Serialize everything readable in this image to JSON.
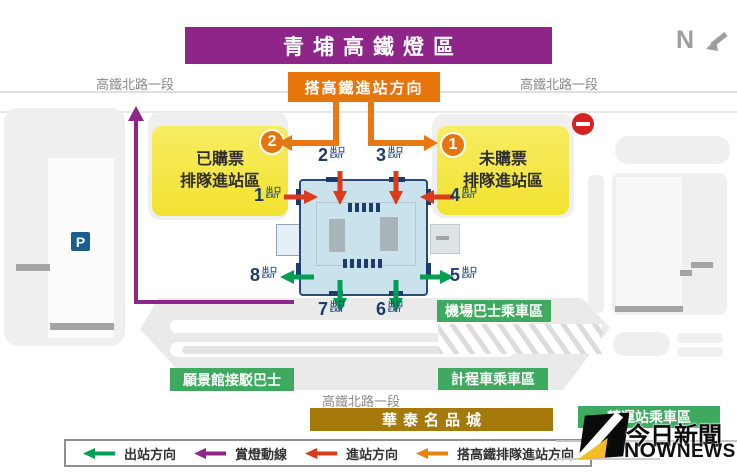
{
  "banner": {
    "title": "青埔高鐵燈區"
  },
  "compass": {
    "label": "N"
  },
  "roads": {
    "top_left": "高鐵北路一段",
    "top_right": "高鐵北路一段",
    "bottom": "高鐵北路一段"
  },
  "callouts": {
    "board_direction": "搭高鐵進站方向"
  },
  "zones": {
    "ticketed": {
      "line1": "已購票",
      "line2": "排隊進站區",
      "badge": "2"
    },
    "unticketed": {
      "line1": "未購票",
      "line2": "排隊進站區",
      "badge": "1"
    },
    "airport_bus": "機場巴士乘車區",
    "taxi": "計程車乘車區",
    "shuttle_bus": "願景館接駁巴士",
    "transfer": "轉運站乘車區",
    "outlet_mall": "華泰名品城"
  },
  "parking": {
    "label": "P"
  },
  "exit": {
    "word": "出口",
    "word_en": "EXIT",
    "numbers": {
      "e1": "1",
      "e2": "2",
      "e3": "3",
      "e4": "4",
      "e5": "5",
      "e6": "6",
      "e7": "7",
      "e8": "8"
    }
  },
  "legend": {
    "items": [
      {
        "label": "出站方向",
        "color": "#009F53"
      },
      {
        "label": "賞燈動線",
        "color": "#8E2689"
      },
      {
        "label": "進站方向",
        "color": "#DC3A1B"
      },
      {
        "label": "搭高鐵排隊進站方向",
        "color": "#E8820E"
      }
    ]
  },
  "watermark": {
    "cn": "今日新聞",
    "en_bold": "NOW",
    "en_light": "NEWS"
  },
  "colors": {
    "banner_purple": "#8E2689",
    "route_orange": "#E8780F",
    "enter_red": "#DC3A1B",
    "exit_green": "#009F53",
    "lantern_purple": "#8E2689",
    "zone_green": "#3EA95F",
    "outlet_brown": "#A5790A",
    "queue_yellow": "#F6E843",
    "station_blue": "#C9E2EB",
    "navy": "#1C3C6E"
  }
}
